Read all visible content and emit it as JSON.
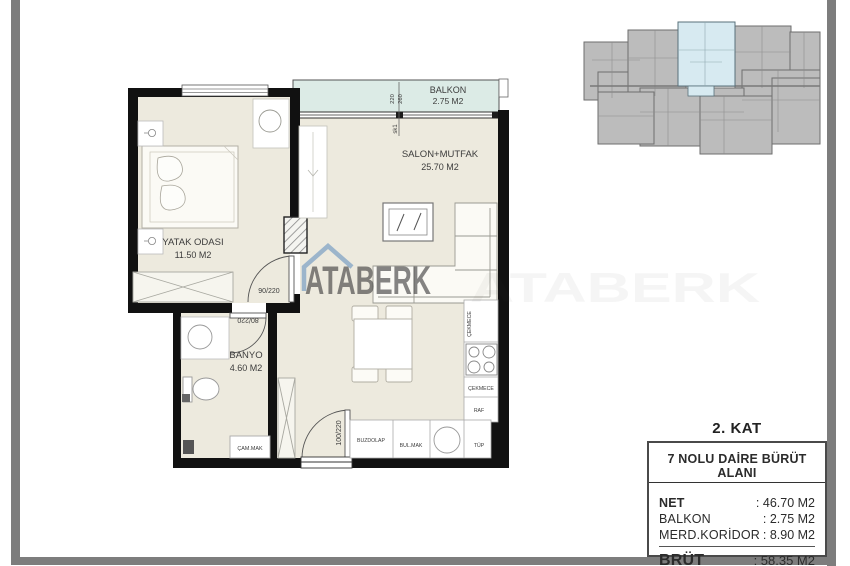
{
  "plan": {
    "bedroom": {
      "name": "YATAK ODASI",
      "area": "11.50 M2"
    },
    "bathroom": {
      "name": "BANYO",
      "area": "4.60 M2"
    },
    "living": {
      "name": "SALON+MUTFAK",
      "area": "25.70 M2"
    },
    "balcony": {
      "name": "BALKON",
      "area": "2.75 M2"
    },
    "doors": {
      "bedroom": "90/220",
      "bathroom": "80/220",
      "entrance": "100/220"
    },
    "dims": {
      "w": "220",
      "h": "260",
      "marker": "sk1"
    },
    "kitchen": {
      "fridge": "BUZDOLAP",
      "dishwasher": "BUL.MAK",
      "tube": "TÜP",
      "shelf": "RAF",
      "drawer": "ÇEKMECE"
    },
    "bath_items": {
      "washing_machine": "ÇAM.MAK"
    }
  },
  "watermark": {
    "brand": "ATABERK"
  },
  "info_panel": {
    "floor": "2. KAT",
    "title": "7 NOLU DAİRE BÜRÜT ALANI",
    "rows": [
      {
        "label": "NET",
        "value": ": 46.70 M2"
      },
      {
        "label": "BALKON",
        "value": ":  2.75 M2"
      },
      {
        "label": "MERD.KORİDOR",
        "value": ":  8.90 M2"
      }
    ],
    "total_label": "BRÜT",
    "total_value": ": 58.35 M2"
  },
  "colors": {
    "wall": "#111111",
    "floor": "#edeade",
    "balcony": "#dcebe6",
    "watermark_blue": "#6a94c0",
    "siteplan_unit": "#bcbcbc",
    "siteplan_highlight": "#d7eaf1",
    "frame_gray": "#7d7d7d"
  }
}
